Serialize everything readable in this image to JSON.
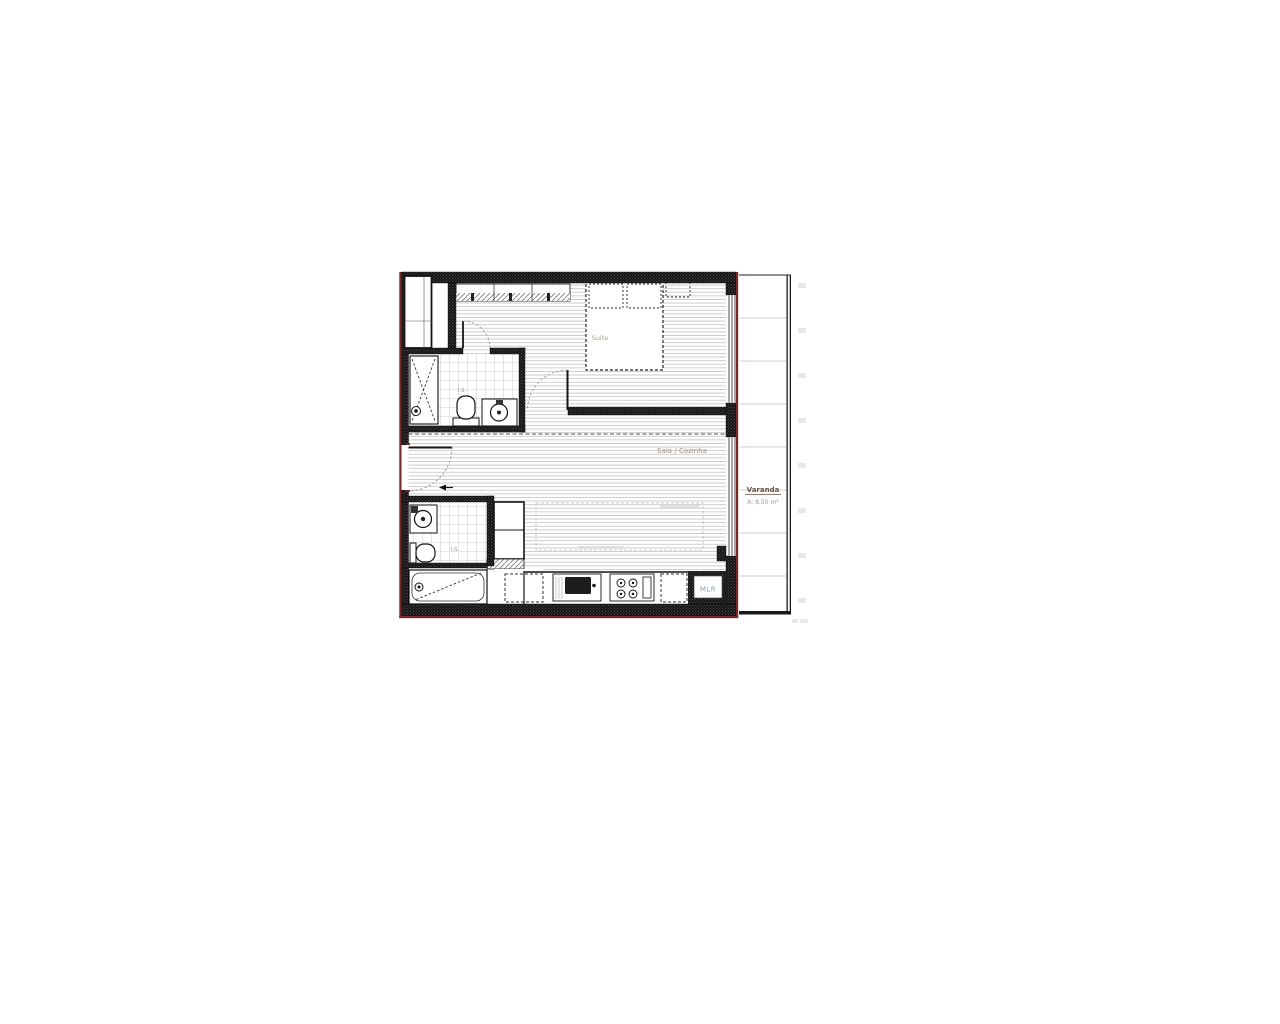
{
  "canvas": {
    "background": "#ffffff"
  },
  "floorplan": {
    "labels": {
      "suite": "Suite",
      "living_kitchen": "Sala / Cozinha",
      "balcony": "Varanda",
      "balcony_area": "A: 8,50 m²",
      "bathroom_top": "I.S.",
      "bathroom_bottom": "I.S.",
      "washer": "MLR"
    },
    "colors": {
      "wall_black": "#161616",
      "exterior_red": "#7a2626",
      "floor_line": "#c9c9c9",
      "tile_line": "#c2c2c2",
      "balcony_grid": "#cdcdcd",
      "living_label": "#9c8e80",
      "suite_label": "#a8a096",
      "is_label": "#9a9a9a",
      "washer_label": "#8d9bb0",
      "balcony_label": "#6b5340",
      "balcony_area_label": "#999999"
    }
  }
}
